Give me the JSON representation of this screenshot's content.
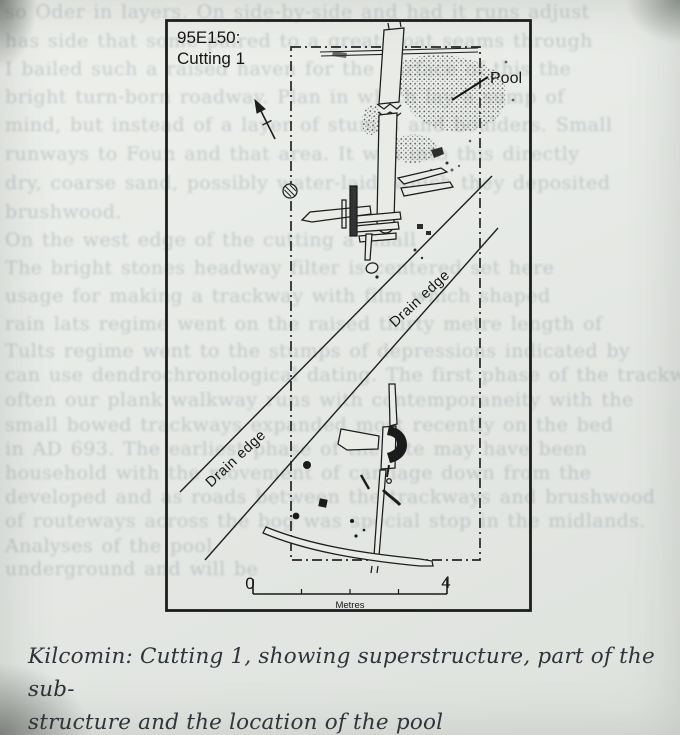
{
  "figure": {
    "site_code": "95E150:",
    "cutting_label": "Cutting 1",
    "pool_label": "Pool",
    "drain_edge_label_upper": "Drain edge",
    "drain_edge_label_lower": "Drain edge",
    "scale_bar": {
      "start_value": "0",
      "end_value": "4",
      "unit_label": "Metres"
    }
  },
  "caption": {
    "line1": "Kilcomin: Cutting 1, showing superstructure, part of the sub-",
    "line2": "structure and the location of the pool"
  },
  "ghost_text": {
    "lines": [
      {
        "y": 1,
        "text": "so Oder in layers. On side-by-side and had it runs adjust"
      },
      {
        "y": 30,
        "text": "has side that some paired to a great boat seams through"
      },
      {
        "y": 58,
        "text": "I bailed such a raised haven for the surface of this the"
      },
      {
        "y": 86,
        "text": "bright turn-born roadway. Plan in which lay a sump of"
      },
      {
        "y": 114,
        "text": "mind, but instead of a layer of stumps and boulders. Small"
      },
      {
        "y": 143,
        "text": "runways to Foun and that area. It was into this directly"
      },
      {
        "y": 172,
        "text": "dry, coarse sand, possibly water-laid, which they deposited"
      },
      {
        "y": 201,
        "text": "brushwood."
      },
      {
        "y": 229,
        "text": "On the west edge of the cutting a small"
      },
      {
        "y": 257,
        "text": "The bright stones headway filter is centered set here"
      },
      {
        "y": 285,
        "text": "usage for making a trackway with film which shaped"
      },
      {
        "y": 313,
        "text": "rain lats regime went on the raised thirty metre length of"
      },
      {
        "y": 340,
        "text": "Tults regime went to the stumps of depressions indicated by"
      },
      {
        "y": 364,
        "text": "can use dendrochronological dating. The first phase of the trackway"
      },
      {
        "y": 389,
        "text": "often our plank walkway runs with contemporaneity with the"
      },
      {
        "y": 414,
        "text": "small bowed trackways expanded most recently on the bed"
      },
      {
        "y": 438,
        "text": "in AD 693. The earliest phase of the site may have been"
      },
      {
        "y": 462,
        "text": "household with the movement of carriage down from the"
      },
      {
        "y": 486,
        "text": "developed and as roads between the trackways and brushwood"
      },
      {
        "y": 510,
        "text": "of routeways across the bog was special stop in the midlands."
      },
      {
        "y": 535,
        "text": "Analyses of the pool"
      },
      {
        "y": 558,
        "text": "underground and will be"
      }
    ]
  }
}
